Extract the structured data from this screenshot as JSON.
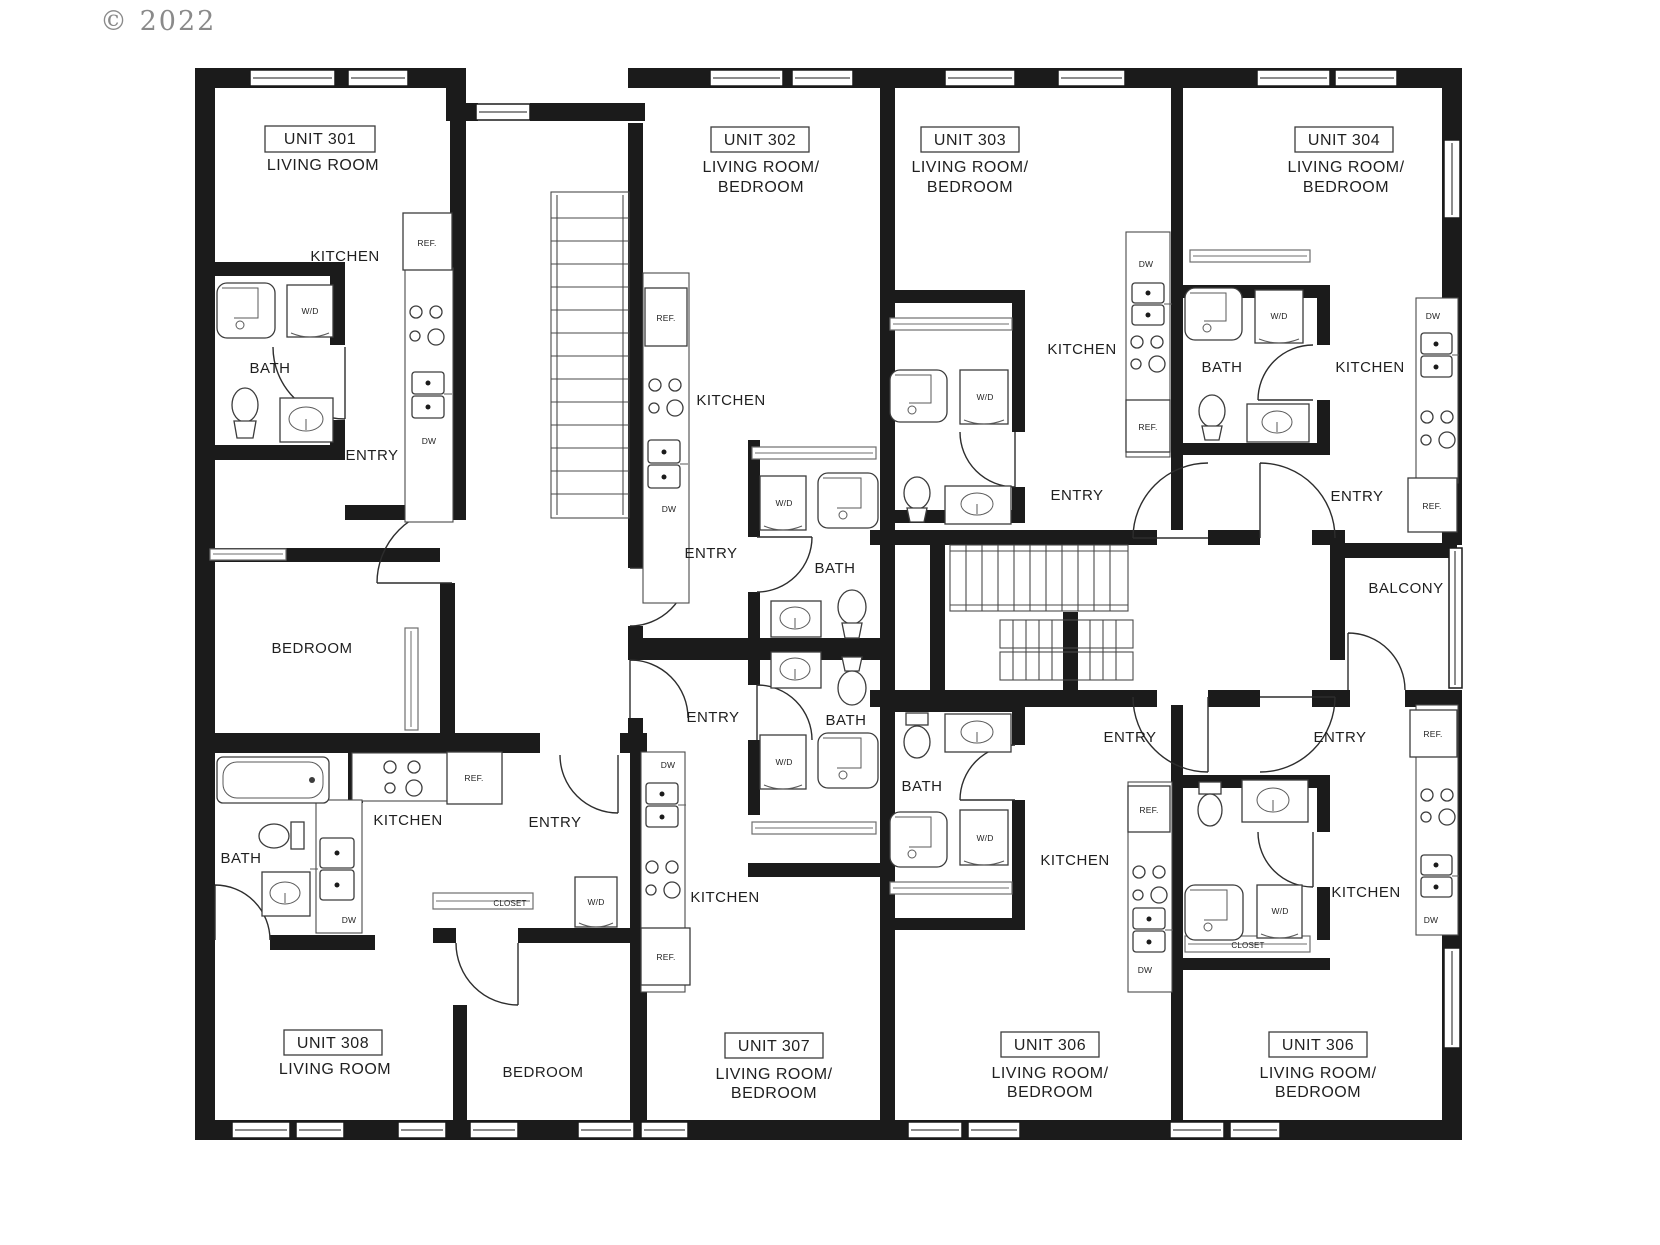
{
  "watermark": "© 2022",
  "colors": {
    "wall": "#1b1b1b",
    "background": "#ffffff",
    "watermark": "#8a8a8a"
  },
  "labels": {
    "kitchen": "KITCHEN",
    "bath": "BATH",
    "entry": "ENTRY",
    "bedroom": "BEDROOM",
    "balcony": "BALCONY",
    "closet": "CLOSET",
    "washer_dryer": "W/D",
    "dishwasher": "DW",
    "refrigerator": "REF."
  },
  "units": [
    {
      "id": "301",
      "name": "UNIT 301",
      "rooms": [
        "LIVING ROOM"
      ]
    },
    {
      "id": "302",
      "name": "UNIT 302",
      "rooms": [
        "LIVING ROOM/",
        "BEDROOM"
      ]
    },
    {
      "id": "303",
      "name": "UNIT 303",
      "rooms": [
        "LIVING ROOM/",
        "BEDROOM"
      ]
    },
    {
      "id": "304",
      "name": "UNIT 304",
      "rooms": [
        "LIVING ROOM/",
        "BEDROOM"
      ]
    },
    {
      "id": "306-left",
      "name": "UNIT 306",
      "rooms": [
        "LIVING ROOM/",
        "BEDROOM"
      ]
    },
    {
      "id": "306-right",
      "name": "UNIT 306",
      "rooms": [
        "LIVING ROOM/",
        "BEDROOM"
      ]
    },
    {
      "id": "307",
      "name": "UNIT 307",
      "rooms": [
        "LIVING ROOM/",
        "BEDROOM"
      ]
    },
    {
      "id": "308",
      "name": "UNIT 308",
      "rooms": [
        "LIVING ROOM"
      ]
    }
  ]
}
